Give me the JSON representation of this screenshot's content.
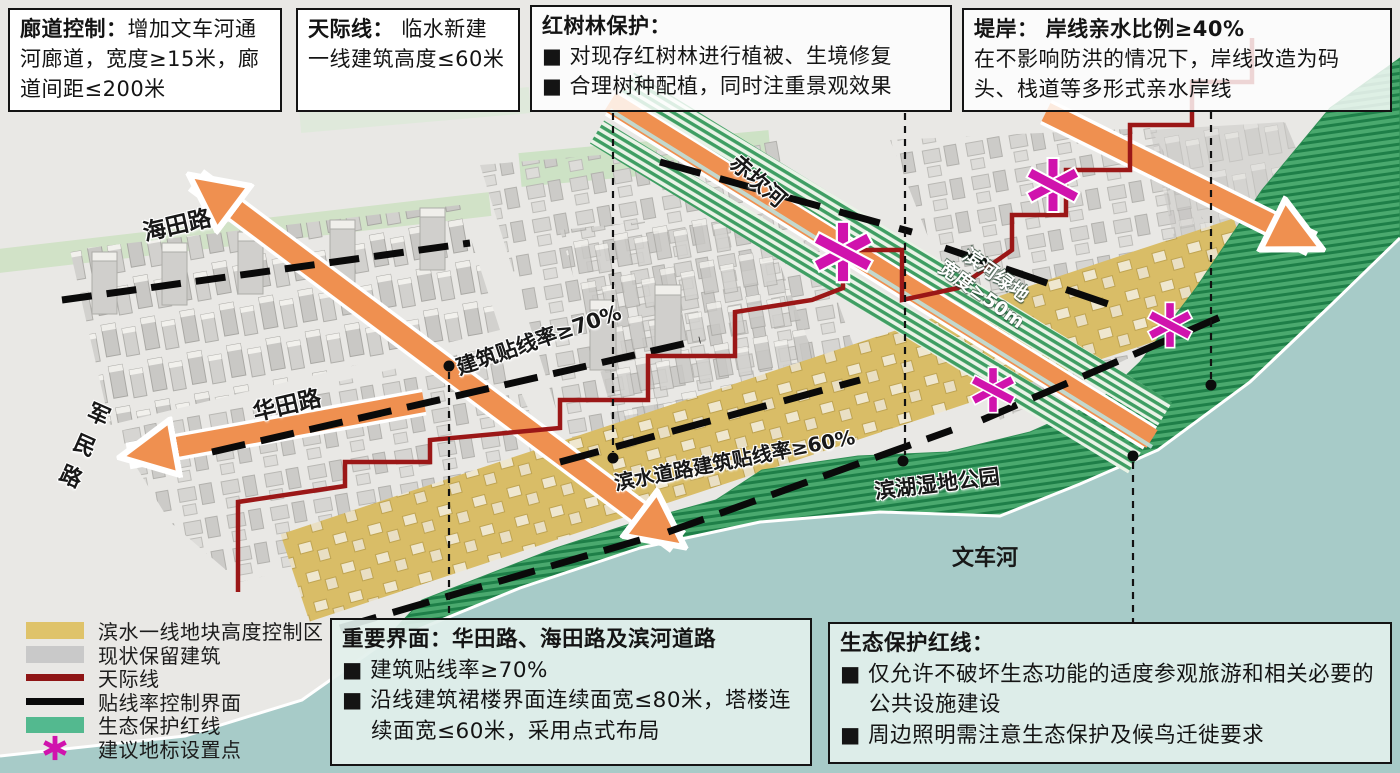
{
  "callouts": {
    "corridor": {
      "title": "廊道控制：",
      "body": "增加文车河通河廊道，宽度≥15米，廊道间距≤200米"
    },
    "skyline": {
      "title": "天际线：",
      "body": "临水新建一线建筑高度≤60米"
    },
    "mangrove": {
      "title": "红树林保护：",
      "bullets": [
        "■ 对现存红树林进行植被、生境修复",
        "■ 合理树种配植，同时注重景观效果"
      ]
    },
    "embankment": {
      "title": "堤岸：",
      "subtitle": "岸线亲水比例≥40%",
      "body": "在不影响防洪的情况下，岸线改造为码头、栈道等多形式亲水岸线"
    },
    "interface": {
      "title": "重要界面：",
      "subtitle": "华田路、海田路及滨河道路",
      "bullets": [
        "■ 建筑贴线率≥70%",
        "■ 沿线建筑裙楼界面连续面宽≤80米，塔楼连续面宽≤60米，采用点式布局"
      ]
    },
    "ecology": {
      "title": "生态保护红线：",
      "bullets": [
        "■ 仅允许不破坏生态功能的适度参观旅游和相关必要的公共设施建设",
        "■ 周边照明需注意生态保护及候鸟迁徙要求"
      ]
    }
  },
  "map_labels": {
    "haitian_road": "海田路",
    "junmin_road": "军民路",
    "huatian_road": "华田路",
    "chikan_river": "赤坎河",
    "riverside_green_line1": "滨河绿地",
    "riverside_green_line2": "宽度≥50m",
    "setback_70": "建筑贴线率≥70%",
    "setback_60": "滨水道路建筑贴线率≥60%",
    "wetland_park": "滨湖湿地公园",
    "wenche_river": "文车河"
  },
  "legend": {
    "items": [
      {
        "label": "滨水一线地块高度控制区",
        "swatch": "tan-fill"
      },
      {
        "label": "现状保留建筑",
        "swatch": "gray-fill"
      },
      {
        "label": "天际线",
        "swatch": "red-line"
      },
      {
        "label": "贴线率控制界面",
        "swatch": "black-line"
      },
      {
        "label": "生态保护红线",
        "swatch": "green-fill"
      },
      {
        "label": "建议地标设置点",
        "swatch": "asterisk"
      }
    ]
  },
  "colors": {
    "corridor_orange": "#ef9050",
    "skyline_red": "#9b1717",
    "interface_black": "#0a0a0a",
    "landmark_magenta": "#d013ad",
    "waterfront_tan": "#d9bd67",
    "retained_building_gray": "#c9c9c9",
    "eco_redline_green": "#53b98f",
    "water_teal": "#a7cbc8"
  }
}
